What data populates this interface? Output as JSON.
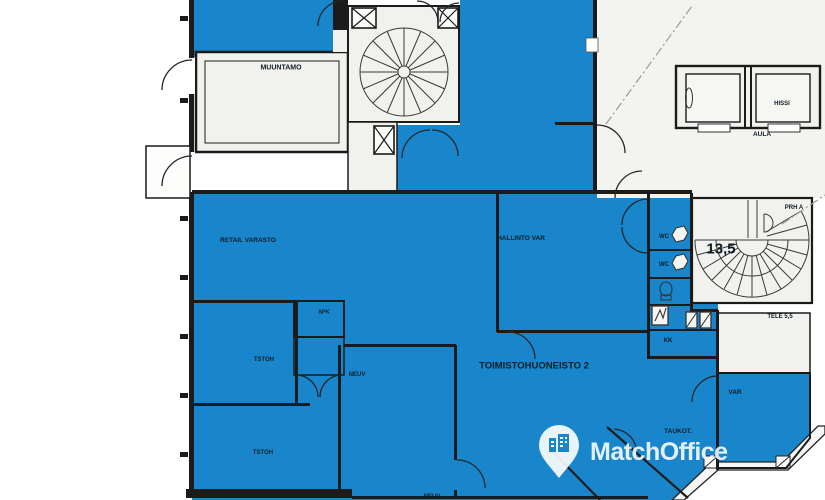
{
  "floorplan": {
    "colors": {
      "highlight_blue": "#1986cb",
      "wall": "#1b1b1b",
      "room_fill": "#f1f1ee"
    },
    "labels": [
      {
        "name": "muuntamo",
        "text": "MUUNTAMO",
        "x": 281,
        "y": 68,
        "size": 7
      },
      {
        "name": "retail-varasto",
        "text": "RETAIL VARASTO",
        "x": 248,
        "y": 241,
        "size": 6.5
      },
      {
        "name": "hallinto-var",
        "text": "HALLINTO VAR",
        "x": 521,
        "y": 239,
        "size": 6.5
      },
      {
        "name": "spk",
        "text": "SPK",
        "x": 324,
        "y": 313,
        "size": 5.5
      },
      {
        "name": "tstoh-1",
        "text": "TSTOH",
        "x": 264,
        "y": 360,
        "size": 6
      },
      {
        "name": "neuv-1",
        "text": "NEUV",
        "x": 357,
        "y": 375,
        "size": 6
      },
      {
        "name": "tstoh-2",
        "text": "TSTOH",
        "x": 263,
        "y": 453,
        "size": 6
      },
      {
        "name": "neuv-2",
        "text": "NEUV",
        "x": 432,
        "y": 497,
        "size": 6
      },
      {
        "name": "toimistohuoneisto-2",
        "text": "TOIMISTOHUONEISTO 2",
        "x": 534,
        "y": 366,
        "size": 9.5
      },
      {
        "name": "wc-1",
        "text": "WC",
        "x": 664,
        "y": 237,
        "size": 6
      },
      {
        "name": "wc-2",
        "text": "WC",
        "x": 664,
        "y": 265,
        "size": 6
      },
      {
        "name": "kk",
        "text": "KK",
        "x": 668,
        "y": 341,
        "size": 6
      },
      {
        "name": "var",
        "text": "VAR",
        "x": 735,
        "y": 393,
        "size": 6.5
      },
      {
        "name": "taukot",
        "text": "TAUKOT.",
        "x": 678,
        "y": 432,
        "size": 6.5
      },
      {
        "name": "stair-area-13-5",
        "text": "13,5",
        "x": 721,
        "y": 249,
        "size": 15
      },
      {
        "name": "prh-a",
        "text": "PRH A",
        "x": 794,
        "y": 208,
        "size": 6
      },
      {
        "name": "tele-5-5",
        "text": "TELE 5,5",
        "x": 780,
        "y": 317,
        "size": 6
      },
      {
        "name": "hissi",
        "text": "HISSI",
        "x": 782,
        "y": 104,
        "size": 6
      },
      {
        "name": "aula",
        "text": "AULA",
        "x": 762,
        "y": 135,
        "size": 6.5
      }
    ],
    "watermark": {
      "brand": "MatchOffice",
      "icon": "location-pin-building-icon"
    }
  }
}
